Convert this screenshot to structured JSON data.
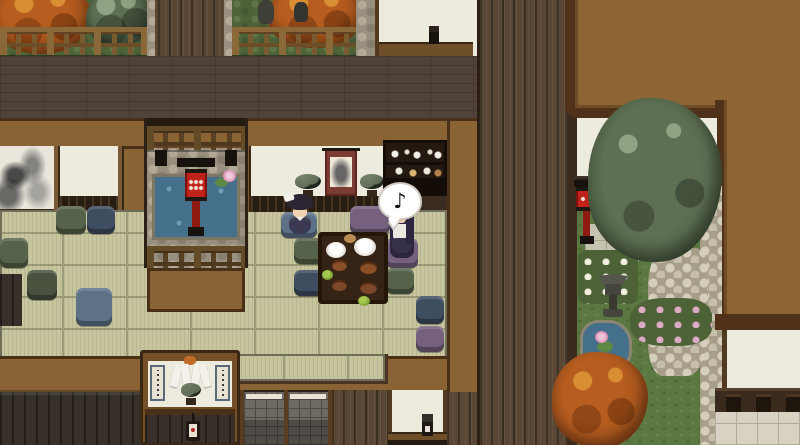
{
  "scene": {
    "description": "Top-down Japanese estate: tea room with two girls at a low table, courtyard pond with red lantern, shrine alcove, and rock garden",
    "speech_bubble": {
      "symbol": "♪"
    }
  },
  "palette": {
    "roof": "#8d6535",
    "roofBorder": "#50321a",
    "wall": "#8a6335",
    "frame": "#452e18",
    "plankH": "#51423a",
    "plankV": "#594733",
    "white": "#edeade",
    "tatami": "#c6c59d",
    "tatamiLine": "#9d9c7a",
    "tatamiEdge": "#70705a",
    "water": "#44708b",
    "stone": "#998f7e",
    "cobble": "#cfc8b4",
    "grass": "#5a7840",
    "tree": "#5d7053",
    "treeDark": "#39462f",
    "treeLight": "#91a383",
    "autumn": "#b65d1f",
    "autumnLight": "#d98e33",
    "lanternRed": "#bf2218",
    "cushionNavy": "#3f4d61",
    "cushionGreen": "#57624a",
    "cushionPurple": "#75607f",
    "cushionBlue": "#5d7187",
    "cushionTeal": "#49513f",
    "skin": "#f2d4b2",
    "hair": "#2b2433",
    "shoji": "#6e6962"
  }
}
